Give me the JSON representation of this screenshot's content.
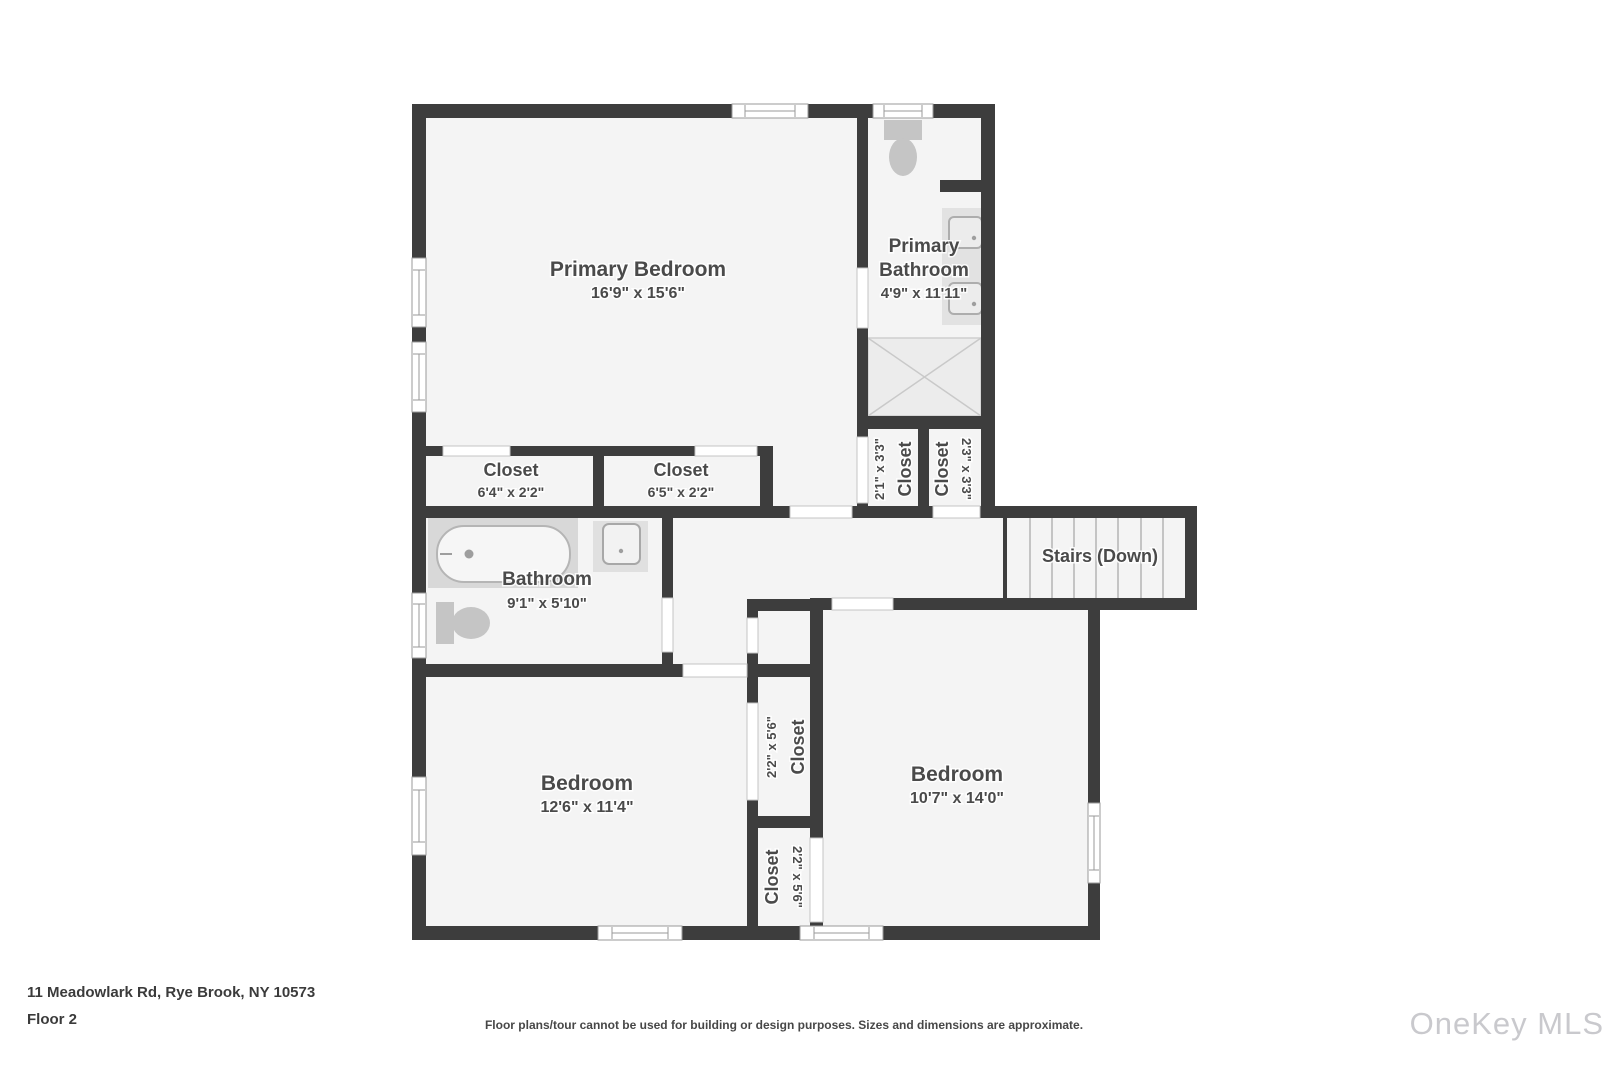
{
  "address": "11 Meadowlark Rd, Rye Brook, NY 10573",
  "floor_label": "Floor 2",
  "disclaimer": "Floor plans/tour cannot be used for building or design purposes. Sizes and dimensions are approximate.",
  "watermark": "OneKey MLS",
  "colors": {
    "wall": "#3d3d3d",
    "room_fill": "#f4f4f4",
    "label_text": "#4a4a4a",
    "fixture_gray": "#c5c5c5",
    "watermark_gray": "#c9c9cd"
  },
  "rooms": {
    "primary_bedroom": {
      "name": "Primary Bedroom",
      "dims": "16'9\" x 15'6\""
    },
    "primary_bathroom": {
      "name_line1": "Primary",
      "name_line2": "Bathroom",
      "dims": "4'9\" x 11'11\""
    },
    "closet_a": {
      "name": "Closet",
      "dims": "6'4\" x 2'2\""
    },
    "closet_b": {
      "name": "Closet",
      "dims": "6'5\" x 2'2\""
    },
    "closet_c": {
      "name": "Closet",
      "dims": "2'1\" x 3'3\""
    },
    "closet_d": {
      "name": "Closet",
      "dims": "2'3\" x 3'3\""
    },
    "stairs": {
      "name": "Stairs (Down)"
    },
    "bathroom": {
      "name": "Bathroom",
      "dims": "9'1\" x 5'10\""
    },
    "bedroom_left": {
      "name": "Bedroom",
      "dims": "12'6\" x 11'4\""
    },
    "bedroom_right": {
      "name": "Bedroom",
      "dims": "10'7\" x 14'0\""
    },
    "closet_e": {
      "name": "Closet",
      "dims": "2'2\" x 5'6\""
    },
    "closet_f": {
      "name": "Closet",
      "dims": "2'2\" x 5'6\""
    }
  }
}
